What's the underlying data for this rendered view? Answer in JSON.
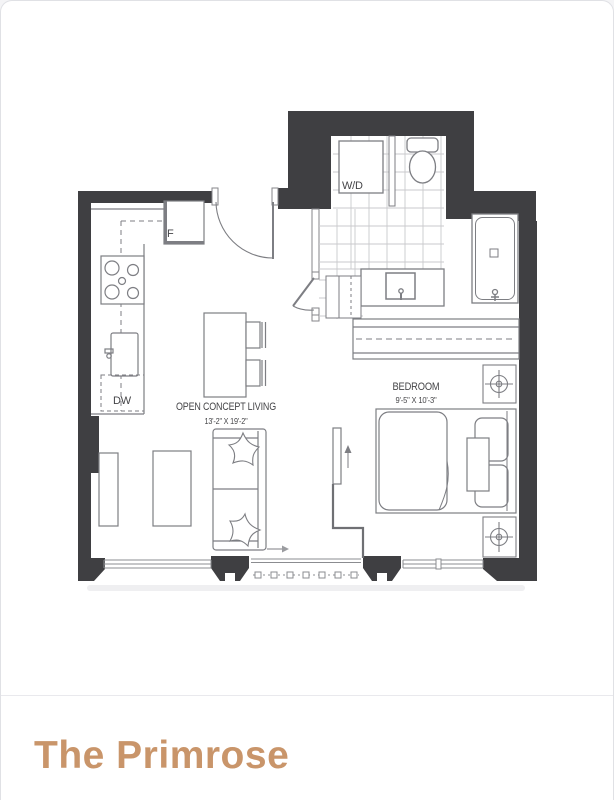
{
  "card": {
    "title": "The Primrose"
  },
  "plan": {
    "appliances": {
      "washer_dryer": "W/D",
      "fridge": "F",
      "dishwasher": "DW"
    },
    "rooms": {
      "living": {
        "name": "OPEN CONCEPT LIVING",
        "dims": "13'-2\" X 19'-2\""
      },
      "bedroom": {
        "name": "BEDROOM",
        "dims": "9'-5\" X 10'-3\""
      }
    },
    "colors": {
      "wall": "#3f3f42",
      "fixture_line": "#7d7e83",
      "tile_line": "#c9cacd",
      "label_text": "#454548",
      "title_accent": "#c9956a",
      "card_border": "#e0e1e5"
    }
  }
}
